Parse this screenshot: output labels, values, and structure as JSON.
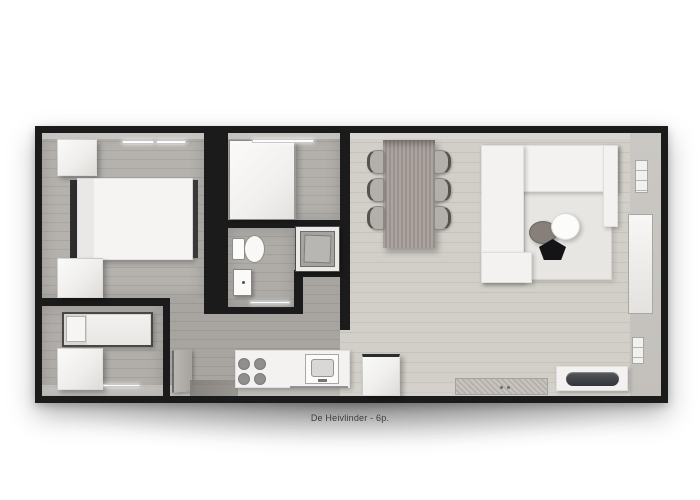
{
  "caption": {
    "text": "De Heivlinder - 6p."
  },
  "palette": {
    "background": "#ffffff",
    "wall": "#1b1b1b",
    "floor_hall": "#a8a5a1",
    "floor_living": "#d2cec8",
    "wall_face_right": "#c7c4c0",
    "furniture_white": "#f3f2f0",
    "dining_table": "#a39a96",
    "tv_screen": "#3c3e42",
    "appliance_face": "#a5a3a0",
    "headboard_dark": "#2f2e2e"
  },
  "rooms": [
    {
      "name": "master-bedroom"
    },
    {
      "name": "shower-room"
    },
    {
      "name": "toilet"
    },
    {
      "name": "bunk-bedroom"
    },
    {
      "name": "hallway"
    },
    {
      "name": "kitchen"
    },
    {
      "name": "living-dining-room"
    }
  ],
  "furniture": [
    "double-bed",
    "wardrobe",
    "nightstand",
    "bunk-bed",
    "shower",
    "toilet",
    "hand-basin",
    "washing-machine",
    "kitchen-counter",
    "cooktop",
    "kitchen-sink",
    "fridge",
    "dining-table",
    "dining-chairs",
    "corner-sofa",
    "rug",
    "coffee-tables",
    "tv-sideboard",
    "doormat",
    "windows",
    "entrance-door"
  ]
}
